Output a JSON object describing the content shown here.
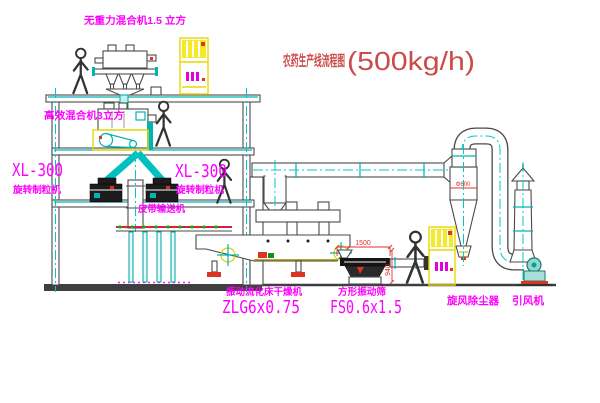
{
  "title": {
    "text": "农药生产线流程图",
    "capacity": "(500kg/h)"
  },
  "equipment": {
    "top_mixer": "无重力混合机1.5 立方",
    "mid_mixer": "高效混合机3立方",
    "granulator_left_model": "XL-300",
    "granulator_left_name": "旋转制粒机",
    "granulator_right_model": "XL-300",
    "granulator_right_name": "旋转制粒机",
    "belt_conveyor": "皮带输送机",
    "dryer_name": "振动流化床干燥机",
    "dryer_model": "ZLG6x0.75",
    "screen_name": "方形振动筛",
    "screen_model": "FS0.6x1.5",
    "cyclone_name": "旋风除尘器",
    "fan_name": "引风机"
  },
  "dimensions": {
    "screen_length": "1500",
    "screen_stand_height": "940",
    "cyclone_dia": "Φ600"
  },
  "colors": {
    "label": "#ff00ff",
    "title": "#cc4a4a",
    "dim": "#e03030",
    "cad_cyan": "#00c8c8",
    "cabinet_yellow": "#e8d800"
  }
}
